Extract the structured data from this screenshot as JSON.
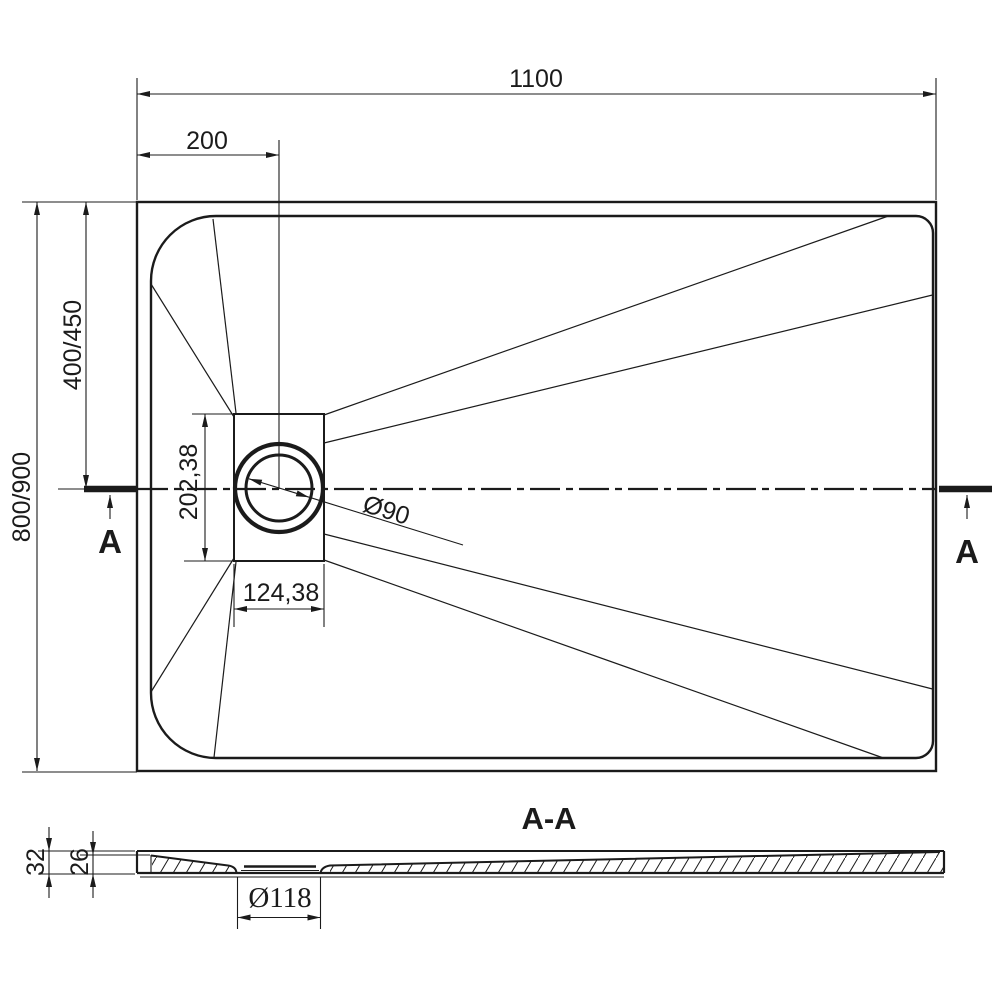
{
  "top_view": {
    "dim_total_width": "1100",
    "dim_drain_offset_x": "200",
    "dim_center_from_top": "400/450",
    "dim_total_depth": "800/900",
    "dim_drain_plate_height": "202,38",
    "dim_drain_plate_width": "124,38",
    "dim_drain_diameter": "Ø90",
    "section_label_left": "A",
    "section_label_right": "A"
  },
  "section_view": {
    "title": "A-A",
    "dim_total_thickness": "32",
    "dim_edge_thickness": "26",
    "dim_drain_hole_diameter": "Ø118"
  },
  "colors": {
    "ink": "#1b1b1b",
    "paper": "#ffffff"
  }
}
